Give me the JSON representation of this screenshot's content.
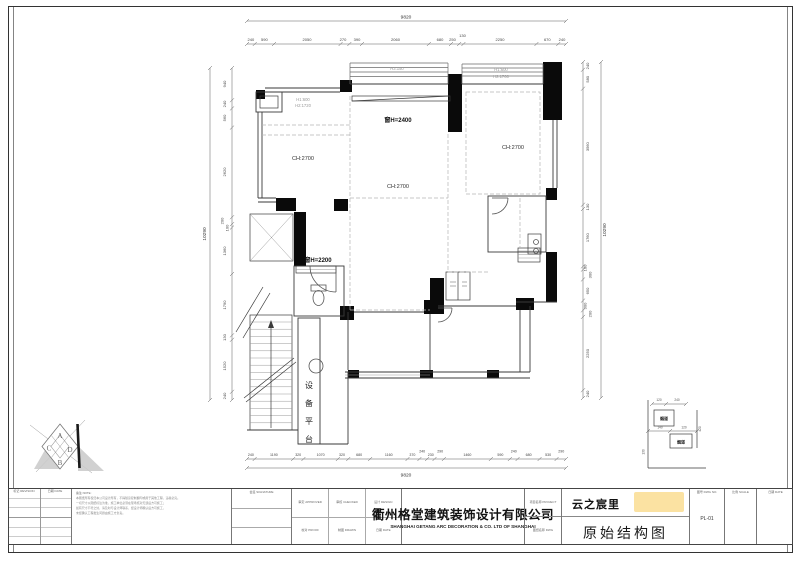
{
  "plan": {
    "labels": {
      "win_tl_1": "H1:600",
      "win_tl_2": "H2:1720",
      "win_tm": "H3:150",
      "win_tr_1": "H1:600",
      "win_tr_2": "H2:1760",
      "window_h_2400": "窗H=2400",
      "window_h_2200": "窗H=2200",
      "ch_living": "CH:2700",
      "ch_center": "CH:2700",
      "ch_bed": "CH:2700",
      "equip_1": "设",
      "equip_2": "备",
      "equip_3": "平",
      "equip_4": "台",
      "flue_1": "烟道",
      "flue_2": "烟道"
    },
    "dims": {
      "top_total": "9820",
      "top": [
        "240",
        "590",
        "2050",
        "270",
        "390",
        "2060",
        "680",
        "250",
        "130",
        "2250",
        "670",
        "240"
      ],
      "bottom_total": "9820",
      "bottom": [
        "240",
        "1190",
        "320",
        "1070",
        "320",
        "680",
        "1160",
        "370",
        "240",
        "230",
        "290",
        "1460",
        "590",
        "240",
        "680",
        "530",
        "290"
      ],
      "left_total": "10290",
      "left": [
        "940",
        "240",
        "560",
        "2620",
        "200",
        "100",
        "1360",
        "1790",
        "130",
        "1520",
        "240"
      ],
      "right_total": "10290",
      "right": [
        "240",
        "580",
        "3560",
        "130",
        "1760",
        "100",
        "300",
        "650",
        "300",
        "200",
        "2250",
        "240"
      ],
      "detail": [
        "120",
        "240",
        "420",
        "140",
        "120",
        "130"
      ]
    },
    "logo": {
      "a": "A",
      "b": "B",
      "c": "C",
      "d": "D"
    }
  },
  "titleblock": {
    "company_cn": "衢州格堂建筑装饰设计有限公司",
    "company_en": "SHANGHAI GETANG ARC DECORATION  &  CO. LTD OF SHANGHAI",
    "rev_label": "标记 REVISION",
    "date_label": "日期 DATE",
    "note_label": "备注 NOTE:",
    "notes": [
      "本图纸所有权归本公司设计所有，不得随意复制翻印或用于其他工程，违者必究。",
      "一切尺寸以图纸标注为准，施工单位必须在现场核对无误后方可施工；",
      "如有尺寸不符之处，请及时与设计师联系，经设计师确认后方可施工，",
      "未经确认工程发生问题由施工方负责。"
    ],
    "sign_label": "会签 SIGNATURE",
    "approved_label": "审定 APPROVED",
    "checked_label": "审核 CHECKED",
    "designed_label": "设计 DESIGN",
    "proofed_label": "校对 PROOF",
    "drawn_label": "制图 DRAWN",
    "date2_label": "日期 DATE",
    "project_label": "项目名称 PROJECT",
    "dwg_label": "图纸名称 DWG",
    "project_name": "云之宸里",
    "drawing_name": "原始结构图",
    "no_label": "图号 DWG NO.",
    "scale_label": "比例 SCALE",
    "date3_label": "日期 DATE",
    "drawing_no": "PL-01"
  }
}
